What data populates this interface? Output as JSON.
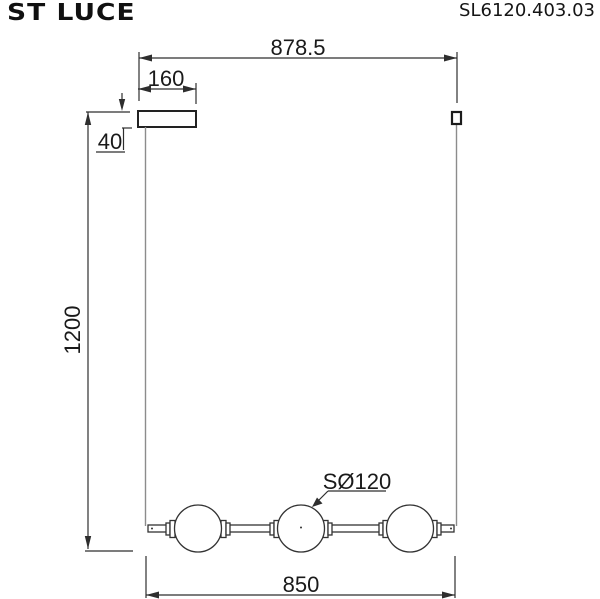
{
  "header": {
    "brand": "ST LUCE",
    "model": "SL6120.403.03"
  },
  "drawing": {
    "kind": "technical dimension drawing of a linear pendant lamp with three spherical shades",
    "dims": {
      "total_width": "878.5",
      "canopy_width": "160",
      "canopy_height": "40",
      "total_height": "1200",
      "shade_diameter": "SØ120",
      "bar_length": "850"
    }
  },
  "colors": {
    "background": "#ffffff",
    "line": "#2e2e2e",
    "wire": "#8c8c8c",
    "text": "#1a1a1a"
  }
}
